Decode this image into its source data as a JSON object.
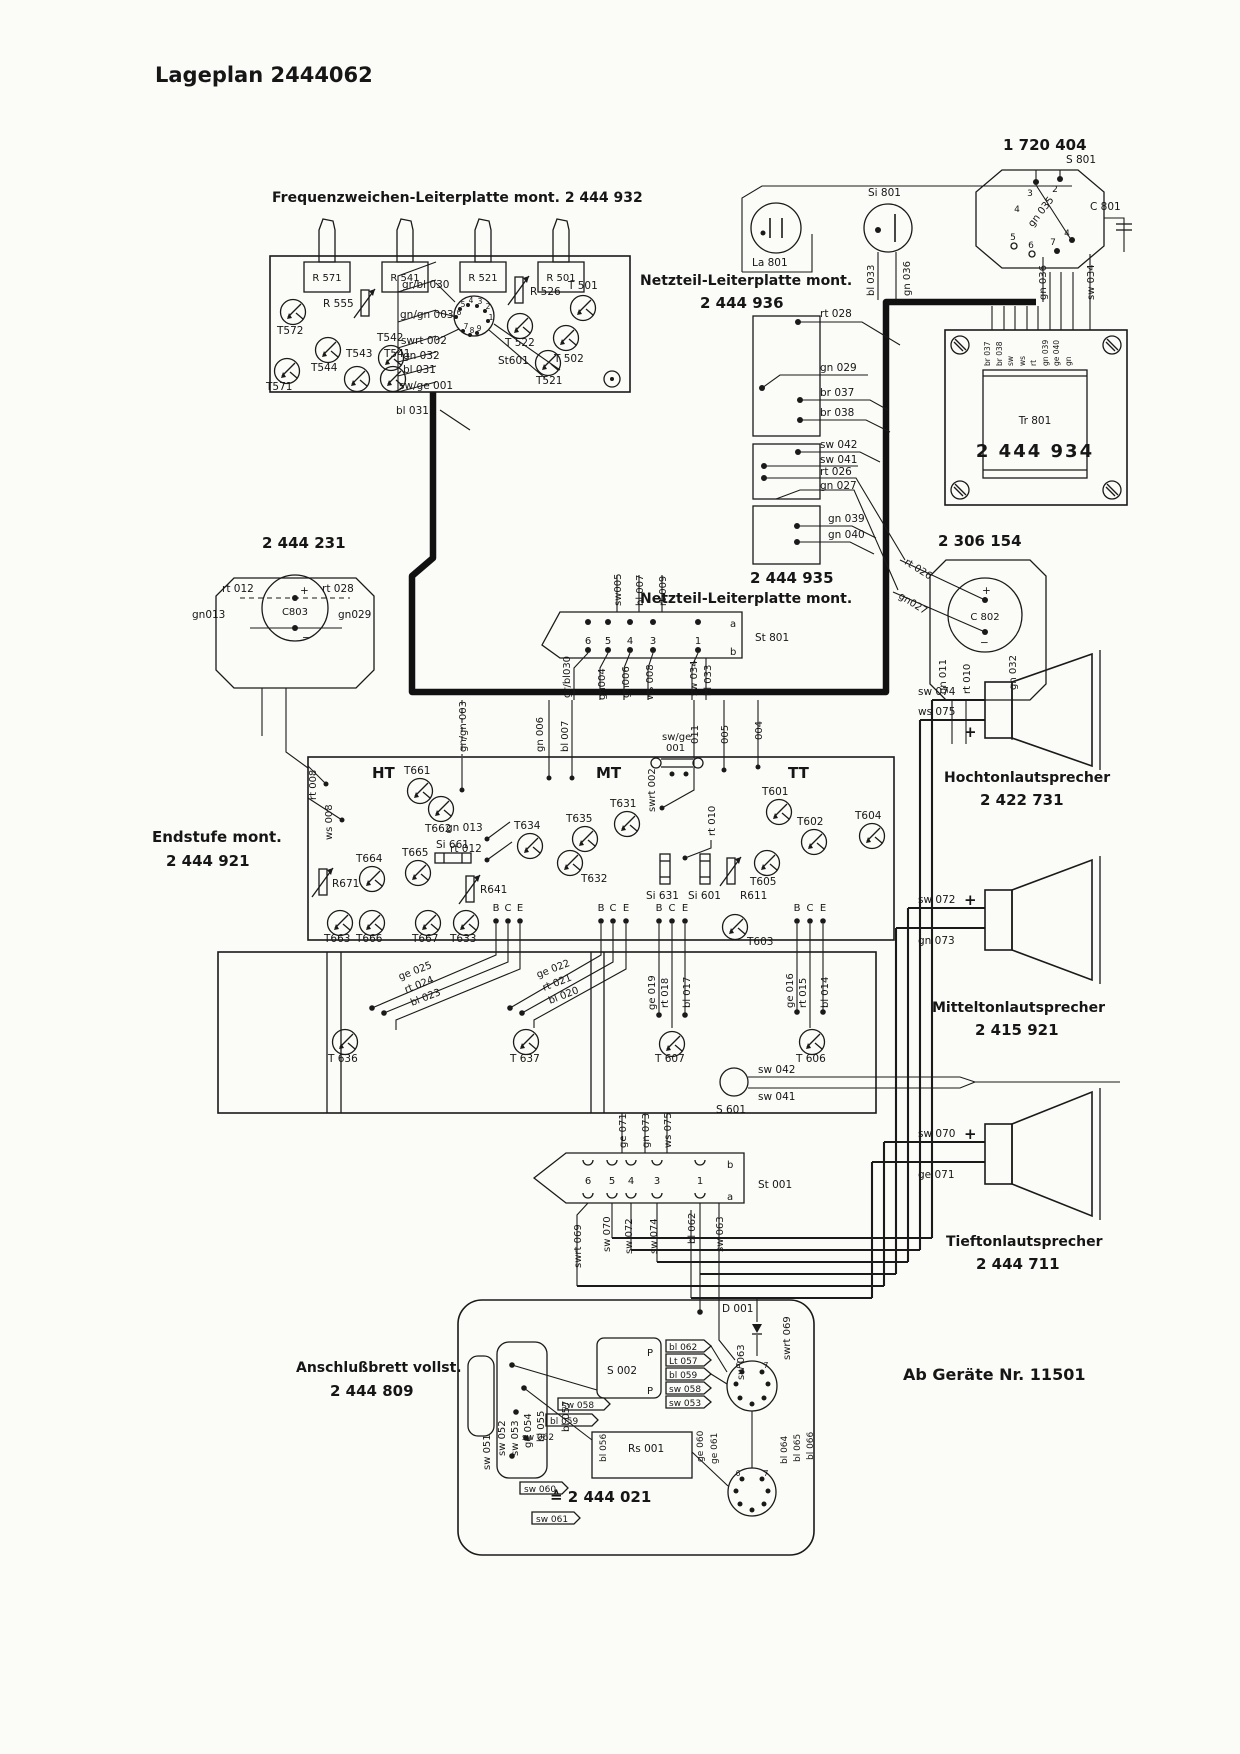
{
  "page": {
    "title": "Lageplan 2444062",
    "footer": "Ab Geräte  Nr. 11501"
  },
  "freq": {
    "caption": "Frequenzweichen-Leiterplatte mont. 2 444 932",
    "pots": [
      "R 571",
      "R 541",
      "R 521",
      "R 501"
    ],
    "t572": "T572",
    "t544": "T544",
    "t542": "T542",
    "t543": "T543",
    "t541": "T541",
    "t571": "T571",
    "t501": "T 501",
    "t522": "T 522",
    "t502": "T 502",
    "t521": "T521",
    "r555": "R 555",
    "r526": "R 526",
    "st601": "St601",
    "st601_pins": [
      "5",
      "4",
      "3",
      "2",
      "1",
      "6",
      "7",
      "8",
      "9"
    ],
    "wires": [
      "gr/bl 030",
      "gn/gn 003",
      "swrt 002",
      "gn 032",
      "bl 031",
      "sw/ge 001"
    ],
    "below_wire": "bl 031"
  },
  "mains": {
    "part_no": "1 720 404",
    "lamp": "La 801",
    "fuse": "Si 801",
    "plug": "S 801",
    "cap": "C 801",
    "plug_pins": [
      "3",
      "2",
      "4",
      "5",
      "6",
      "7"
    ],
    "pin4b": "4",
    "w_bl033": "bl 033",
    "w_gn036a": "gn 036",
    "w_gn035": "gn 035",
    "w_gn036b": "gn 036",
    "w_sw034": "sw 034"
  },
  "nt936": {
    "caption1": "Netzteil-Leiterplatte mont.",
    "caption2": "2 444 936",
    "box1": [
      "rt 028",
      "gn 029",
      "br 037",
      "br 038"
    ],
    "box2": [
      "sw 042",
      "sw 041",
      "rt 026",
      "gn 027"
    ],
    "box3": [
      "gn 039",
      "gn 040"
    ]
  },
  "trafo": {
    "name": "Tr 801",
    "part_no": "2 444 934",
    "wires": [
      "br 037",
      "br 038",
      "sw",
      "ws",
      "rt",
      "gn 039",
      "ge 040",
      "gn"
    ]
  },
  "c803": {
    "part_no": "2 444 231",
    "name": "C803",
    "plus": "+",
    "minus": "−",
    "w1": "rt 012",
    "w2": "rt 028",
    "w3": "gn013",
    "w4": "gn029"
  },
  "c802": {
    "part_no": "2 306 154",
    "name": "C 802",
    "plus": "+",
    "minus": "−",
    "w1": "rt 026",
    "w2": "gn027",
    "below": [
      "gn 011",
      "rt 010",
      "gn 032"
    ]
  },
  "st801": {
    "caption1": "2 444 935",
    "caption2": "Netzteil-Leiterplatte mont.",
    "name": "St 801",
    "row_a": "a",
    "row_b": "b",
    "pins": [
      "6",
      "5",
      "4",
      "3",
      "1"
    ],
    "top": [
      "sw005",
      "bl 007",
      "rt 009"
    ],
    "bottom": [
      "gr/bl030",
      "gn004",
      "gn006",
      "ws 008",
      "sw 034",
      "bl 033"
    ]
  },
  "amp": {
    "caption1": "Endstufe mont.",
    "caption2": "2 444 921",
    "ht": "HT",
    "mt": "MT",
    "tt": "TT",
    "rt008": "rt 008",
    "ws008": "ws 008",
    "gngn003": "gn/gn 003",
    "gn006": "gn 006",
    "bl007": "bl 007",
    "swge1": "sw/ge",
    "swge2": "001",
    "w011": "011",
    "w005": "005",
    "w004": "004",
    "swrt002": "swrt 002",
    "rt010": "rt 010",
    "t661": "T661",
    "t662": "T662",
    "t664": "T664",
    "t665": "T665",
    "si661": "Si 661",
    "r671": "R671",
    "r641": "R641",
    "gn013": "gn 013",
    "rt012": "rt 012",
    "t663": "T663",
    "t666": "T666",
    "t667": "T667",
    "t633": "T633",
    "t634": "T634",
    "t635": "T635",
    "t631": "T631",
    "t632": "T632",
    "si631": "Si 631",
    "si601": "Si 601",
    "r611": "R611",
    "t601": "T601",
    "t602": "T602",
    "t604": "T604",
    "t605": "T605",
    "t603": "T603",
    "b": "B",
    "c": "C",
    "e": "E",
    "dg1": [
      "ge 025",
      "rt 024",
      "bl 023"
    ],
    "dg2": [
      "ge 022",
      "rt 021",
      "bl 020"
    ],
    "vg1": [
      "ge 019",
      "rt 018",
      "bl 017"
    ],
    "vg2": [
      "ge 016",
      "rt 015",
      "bl 014"
    ],
    "t636": "T 636",
    "t637": "T 637",
    "t607": "T 607",
    "t606": "T 606",
    "s601": "S 601",
    "sw042": "sw 042",
    "sw041": "sw 041"
  },
  "st001": {
    "name": "St 001",
    "row_a": "a",
    "row_b": "b",
    "pins": [
      "6",
      "5",
      "4",
      "3",
      "1"
    ],
    "top": [
      "ge 071",
      "gn 073",
      "ws 075"
    ],
    "bottom": [
      "swrt 069",
      "sw 070",
      "sw 072",
      "sw 074",
      "bl 062",
      "sw 063"
    ]
  },
  "panel": {
    "caption1": "Anschlußbrett vollst.",
    "caption2": "2 444 809",
    "d001": "D 001",
    "s002": "S 002",
    "p1": "P",
    "p2": "P",
    "stack": [
      "bl 062",
      "Lt 057",
      "bl 059",
      "sw 058",
      "sw 053"
    ],
    "rs001": "Rs 001",
    "rs_no": "≙ 2 444 021",
    "left": [
      "sw 051",
      "sw 052",
      "sw 053",
      "ge 054",
      "bl 055",
      "bl 057"
    ],
    "mid": [
      "sw 058",
      "bl 059",
      "sw 062",
      "bl 056"
    ],
    "sw060": "sw 060",
    "sw061": "sw 061",
    "right": [
      "ge 060",
      "ge 061",
      "bl 064",
      "bl 065",
      "bl 066"
    ],
    "sw063": "sw 063",
    "swrt069": "swrt 069",
    "din1_pins": [
      "6",
      "7"
    ],
    "din2_pins": [
      "6",
      "7"
    ]
  },
  "speakers": [
    {
      "name": "Hochtonlautsprecher",
      "part_no": "2 422 731",
      "w1": "sw 074",
      "w2": "ws 075",
      "plus": "+"
    },
    {
      "name": "Mitteltonlautsprecher",
      "part_no": "2 415 921",
      "w1": "sw 072",
      "w2": "gn 073",
      "plus": "+"
    },
    {
      "name": "Tieftonlautsprecher",
      "part_no": "2 444 711",
      "w1": "sw 070",
      "w2": "ge 071",
      "plus": "+"
    }
  ]
}
